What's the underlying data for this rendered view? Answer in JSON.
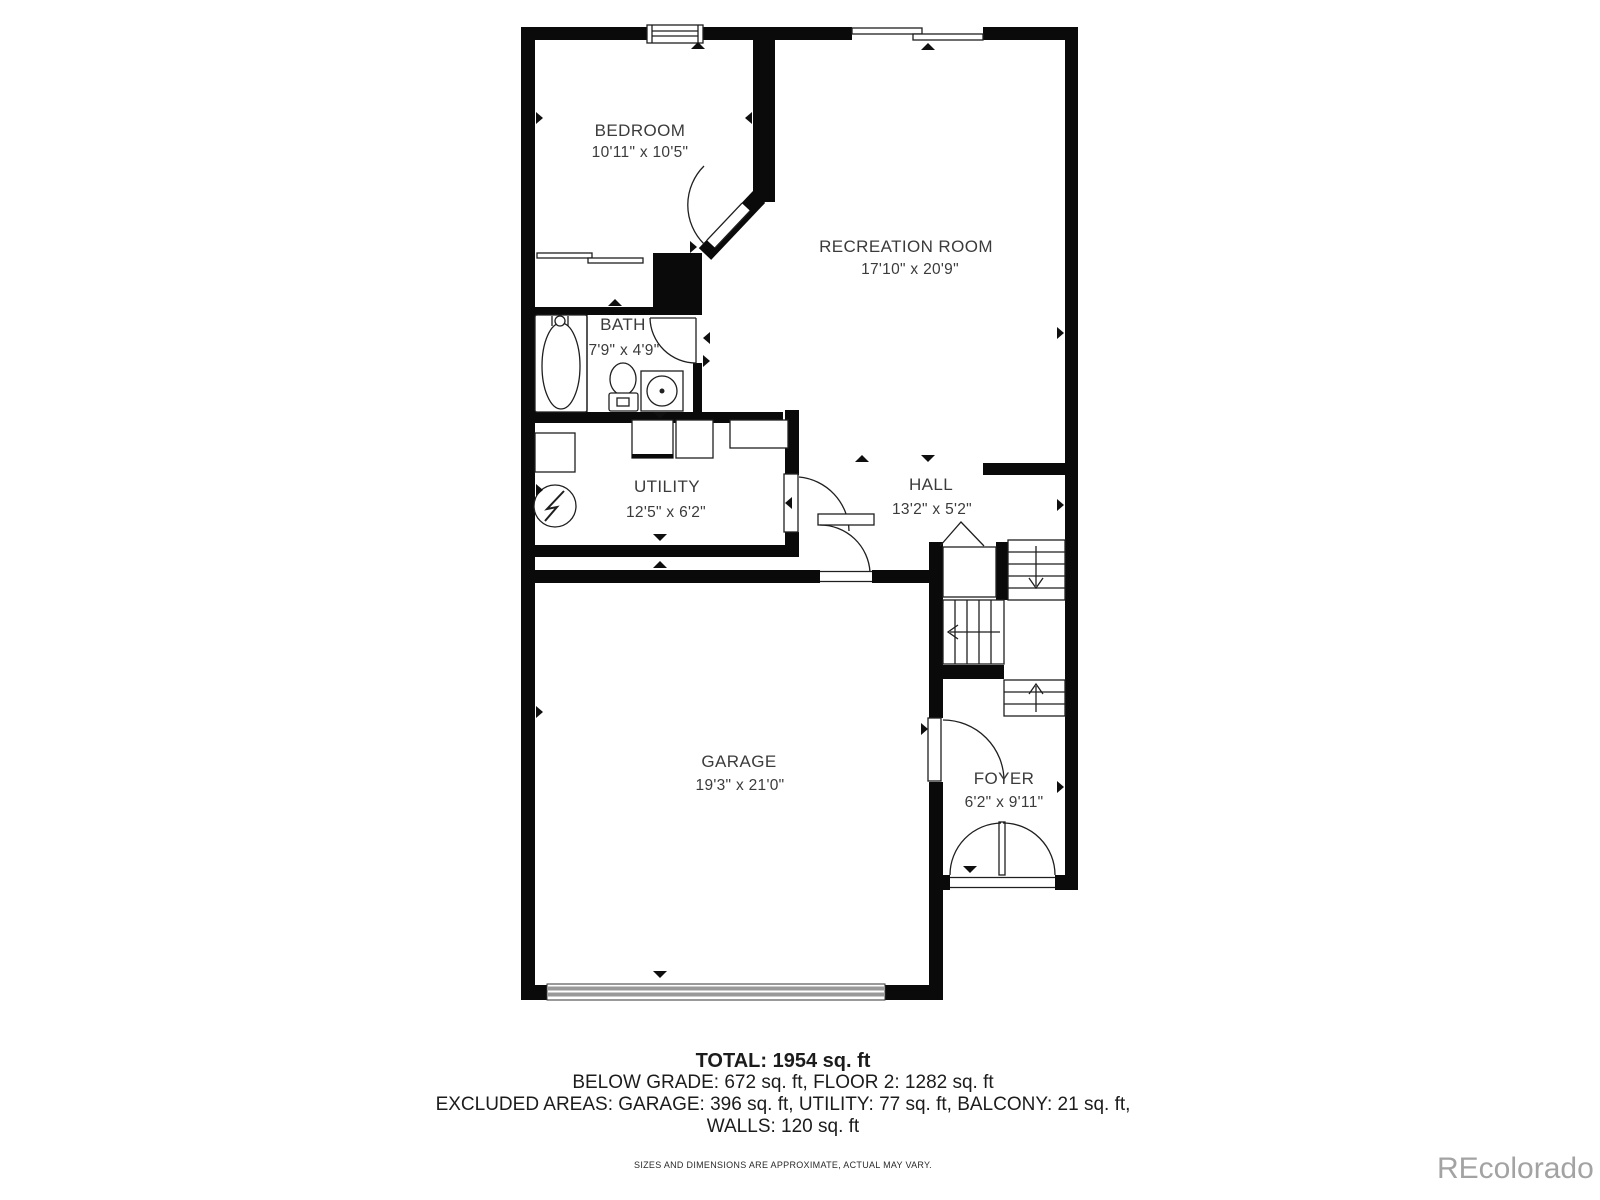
{
  "rooms": {
    "bedroom": {
      "name": "BEDROOM",
      "dims": "10'11\" x 10'5\""
    },
    "recreation": {
      "name": "RECREATION ROOM",
      "dims": "17'10\" x 20'9\""
    },
    "bath": {
      "name": "BATH",
      "dims": "7'9\" x 4'9\""
    },
    "utility": {
      "name": "UTILITY",
      "dims": "12'5\" x 6'2\""
    },
    "hall": {
      "name": "HALL",
      "dims": "13'2\" x 5'2\""
    },
    "garage": {
      "name": "GARAGE",
      "dims": "19'3\" x 21'0\""
    },
    "foyer": {
      "name": "FOYER",
      "dims": "6'2\" x 9'11\""
    }
  },
  "footer": {
    "total": "TOTAL: 1954 sq. ft",
    "below_grade": "BELOW GRADE: 672 sq. ft, FLOOR 2: 1282 sq. ft",
    "excluded": "EXCLUDED AREAS: GARAGE: 396 sq. ft, UTILITY: 77 sq. ft, BALCONY: 21 sq. ft,",
    "walls": "WALLS: 120 sq. ft",
    "disclaimer": "SIZES AND DIMENSIONS ARE APPROXIMATE, ACTUAL MAY VARY."
  },
  "watermark": "REcolorado",
  "symbols": {
    "electrical_panel": "circle-with-lightning-bolt",
    "stair_direction": "open-triangle-and-arrows",
    "dimension_marker": "small-black-triangle"
  },
  "colors": {
    "wall": "#0a0a0a",
    "text": "#3b3b3b",
    "garage_door": "#999999",
    "watermark": "#a3a3a3"
  }
}
